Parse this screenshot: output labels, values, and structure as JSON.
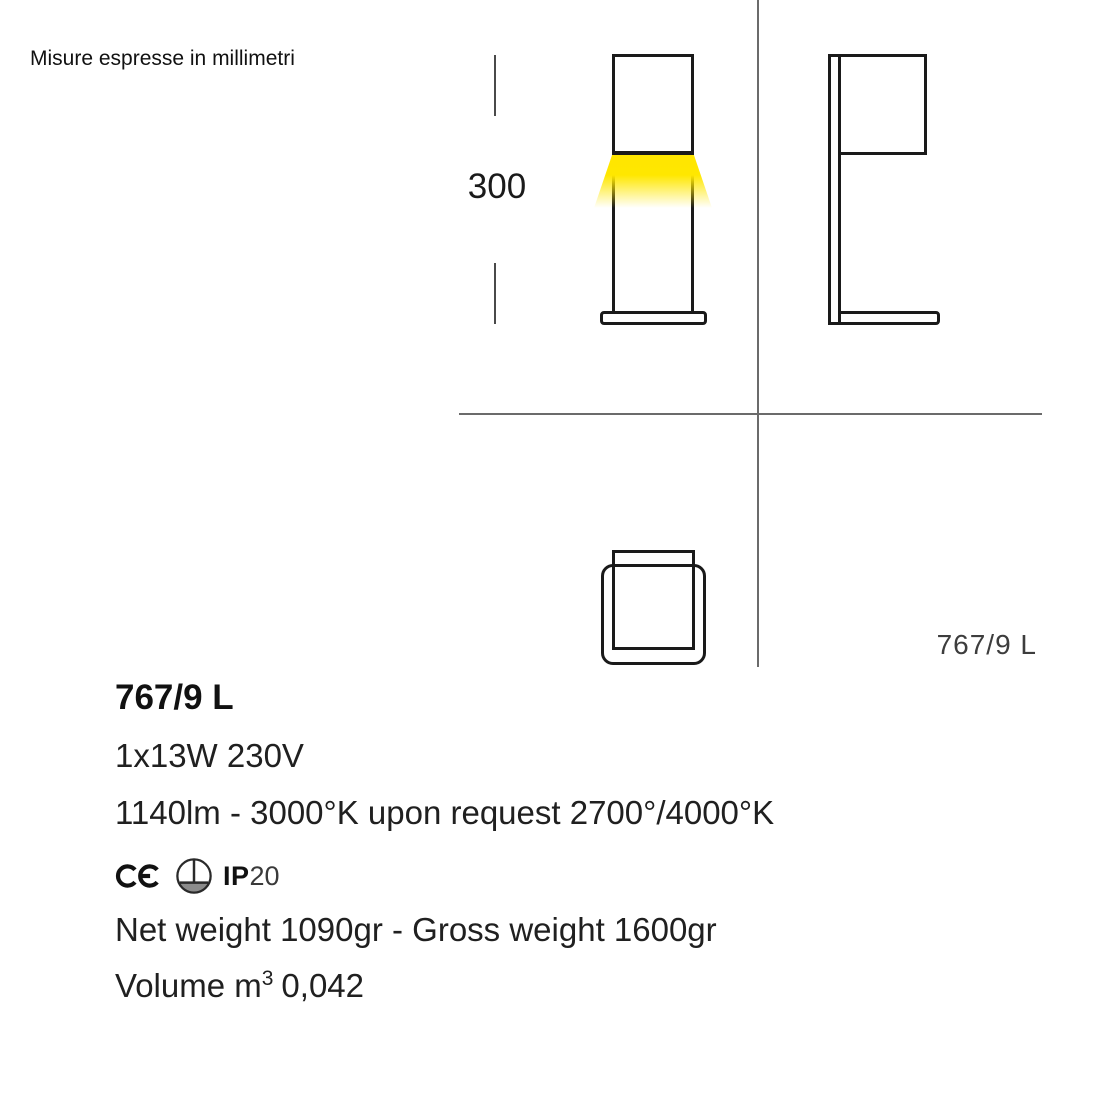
{
  "page": {
    "note": "Misure espresse in millimetri"
  },
  "drawing": {
    "dimension_height": "300",
    "model_label": "767/9 L",
    "glow_color": "#FFE600",
    "line_color": "#1a1a1a",
    "divider_color": "#6b6b6b",
    "views": [
      "front",
      "side",
      "bottom"
    ]
  },
  "specs": {
    "model": "767/9 L",
    "power": "1x13W 230V",
    "color_temp": "1140lm - 3000°K upon request 2700°/4000°K",
    "certifications": {
      "ce_icon": "ce-mark-icon",
      "mounting_icon": "floor-mounting-icon",
      "ip_prefix": "IP",
      "ip_value": "20"
    },
    "weight": "Net weight 1090gr - Gross weight 1600gr",
    "volume": {
      "prefix": "Volume m",
      "sup": "3",
      "value": "0,042"
    }
  }
}
